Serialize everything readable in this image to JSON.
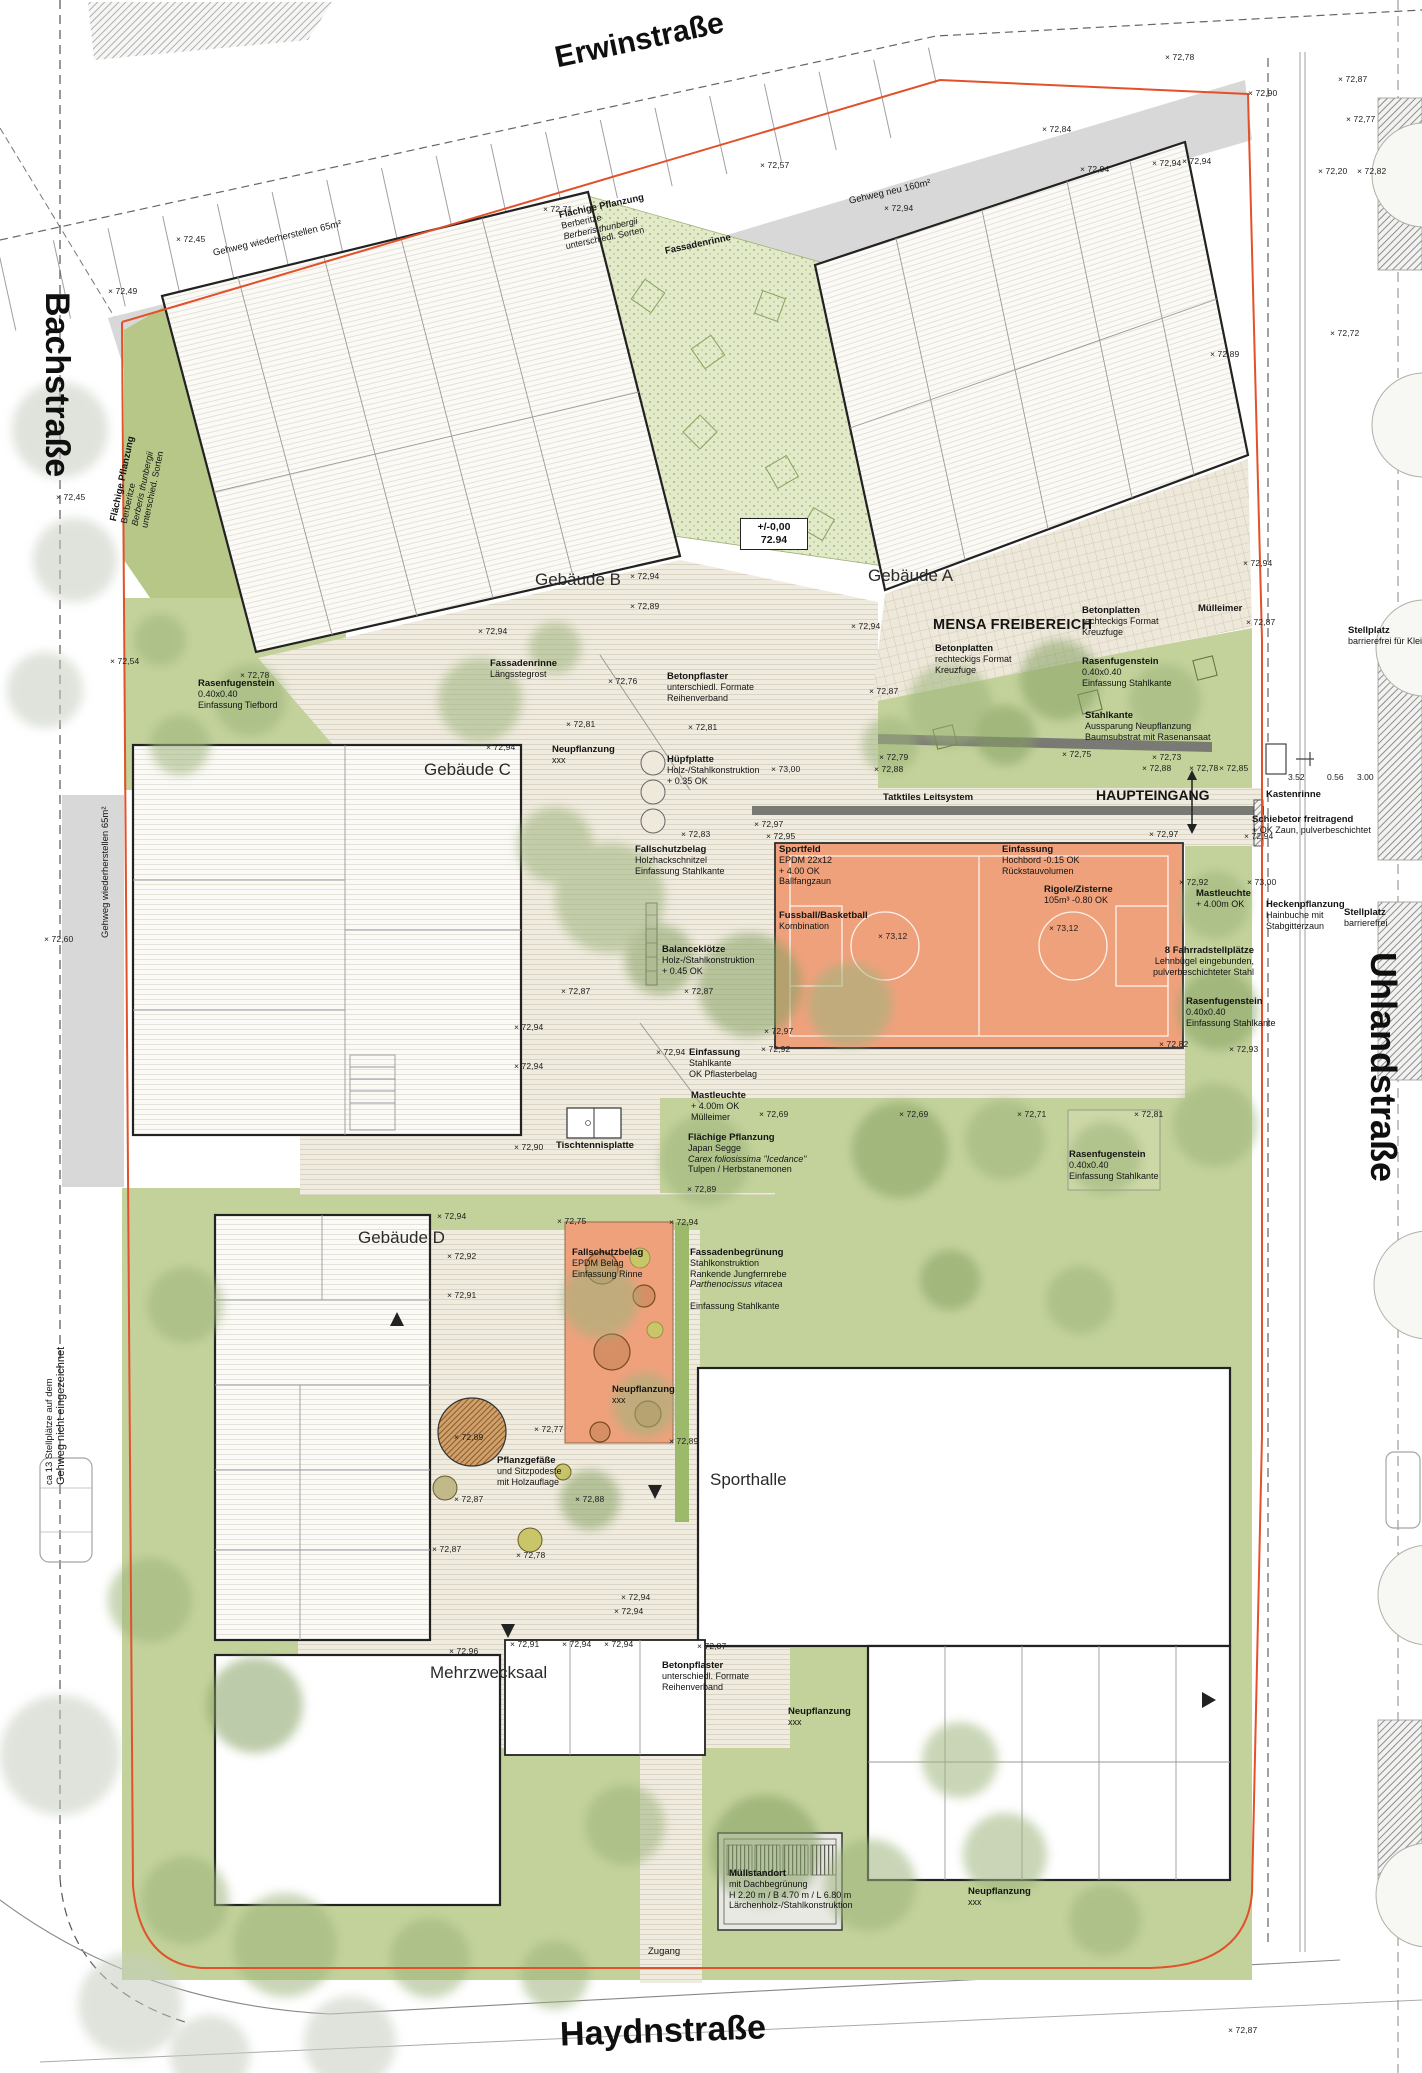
{
  "streets": {
    "top": "Erwinstraße",
    "left": "Bachstraße",
    "right": "Uhlandstraße",
    "bottom": "Haydnstraße"
  },
  "datum": {
    "value_top": "+/-0,00",
    "value_bottom": "72.94"
  },
  "areas": {
    "mensa": "MENSA FREIBEREICH",
    "haupteingang": "HAUPTEINGANG"
  },
  "colors": {
    "boundary": "#e2512a",
    "lawn": "#c3d29b",
    "sportfield": "#efa17c",
    "sidewalk": "#d8d8d8",
    "deck": "#f0ebdf",
    "planting": "#b6c788"
  },
  "buildings": [
    {
      "id": "a",
      "label": "Gebäude A",
      "x": 868,
      "y": 566
    },
    {
      "id": "b",
      "label": "Gebäude B",
      "x": 535,
      "y": 570
    },
    {
      "id": "c",
      "label": "Gebäude C",
      "x": 424,
      "y": 760
    },
    {
      "id": "d",
      "label": "Gebäude D",
      "x": 358,
      "y": 1228
    },
    {
      "id": "sporthalle",
      "label": "Sporthalle",
      "x": 710,
      "y": 1470
    },
    {
      "id": "mehrzwecksaal",
      "label": "Mehrzwecksaal",
      "x": 430,
      "y": 1663
    }
  ],
  "annotations": [
    {
      "id": "gehweg-wiederherstellen-top",
      "x": 212,
      "y": 248,
      "rotate": -13,
      "plain": true,
      "fs": 12.5,
      "title": "Gehweg wiederherstellen 65m²",
      "lines": []
    },
    {
      "id": "gehweg-neu",
      "x": 848,
      "y": 196,
      "rotate": -13,
      "plain": true,
      "fs": 12.5,
      "title": "Gehweg neu 160m²",
      "lines": []
    },
    {
      "id": "flaechige-pflanzung-top",
      "x": 558,
      "y": 210,
      "rotate": -12,
      "title": "Flächige Pflanzung",
      "lines": [
        "Berberitze",
        "Berberis thunbergii",
        "unterschiedl. Sorten"
      ],
      "italics": [
        1
      ]
    },
    {
      "id": "flaechige-pflanzung-left",
      "x": 108,
      "y": 520,
      "rotate": -78,
      "title": "Flächige Pflanzung",
      "lines": [
        "Berberitze",
        "Berberis thunbergii",
        "unterschied. Sorten"
      ],
      "italics": [
        1
      ]
    },
    {
      "id": "fassadenrinne-top",
      "x": 664,
      "y": 246,
      "rotate": -12,
      "title": "Fassadenrinne",
      "lines": []
    },
    {
      "id": "fassadenrinne-laengsstegrost",
      "x": 490,
      "y": 658,
      "title": "Fassadenrinne",
      "lines": [
        "Längsstegrost"
      ]
    },
    {
      "id": "betonpflaster-mitte",
      "x": 667,
      "y": 671,
      "title": "Betonpflaster",
      "lines": [
        "unterschiedl. Formate",
        "Reihenverband"
      ]
    },
    {
      "id": "rasenfugenstein-links",
      "x": 198,
      "y": 678,
      "title": "Rasenfugenstein",
      "lines": [
        "0.40x0.40",
        "Einfassung Tiefbord"
      ]
    },
    {
      "id": "neupflanzung-c",
      "x": 552,
      "y": 744,
      "title": "Neupflanzung",
      "lines": [
        "xxx"
      ]
    },
    {
      "id": "huepfplatte",
      "x": 667,
      "y": 754,
      "title": "Hüpfplatte",
      "lines": [
        "Holz-/Stahlkonstruktion",
        "+ 0.35 OK"
      ]
    },
    {
      "id": "fallschutzbelag-holz",
      "x": 635,
      "y": 844,
      "title": "Fallschutzbelag",
      "lines": [
        "Holzhackschnitzel",
        "Einfassung Stahlkante"
      ]
    },
    {
      "id": "balanceklaetze",
      "x": 662,
      "y": 944,
      "title": "Balanceklötze",
      "lines": [
        "Holz-/Stahlkonstruktion",
        "+ 0.45 OK"
      ]
    },
    {
      "id": "betonplatten-mensa",
      "x": 935,
      "y": 643,
      "title": "Betonplatten",
      "lines": [
        "rechteckigs Format",
        "Kreuzfuge"
      ]
    },
    {
      "id": "betonplatten-rechts",
      "x": 1082,
      "y": 605,
      "title": "Betonplatten",
      "lines": [
        "rechteckigs Format",
        "Kreuzfuge"
      ]
    },
    {
      "id": "muelleimer-mensa",
      "x": 1198,
      "y": 603,
      "title": "Mülleimer",
      "lines": []
    },
    {
      "id": "rasenfugenstein-mensa",
      "x": 1082,
      "y": 656,
      "title": "Rasenfugenstein",
      "lines": [
        "0.40x0.40",
        "Einfassung Stahlkante"
      ]
    },
    {
      "id": "stahlkante-mensa",
      "x": 1085,
      "y": 710,
      "title": "Stahlkante",
      "lines": [
        "Aussparung Neupflanzung",
        "Baumsubstrat mit Rasenansaat"
      ]
    },
    {
      "id": "taktiles-leitsystem",
      "x": 883,
      "y": 792,
      "fs": 10.5,
      "title": "Tatktiles Leitsystem",
      "lines": []
    },
    {
      "id": "kastenrinne",
      "x": 1266,
      "y": 789,
      "fs": 10,
      "title": "Kastenrinne",
      "lines": []
    },
    {
      "id": "schiebetor",
      "x": 1252,
      "y": 814,
      "title": "Schiebetor freitragend",
      "lines": [
        "+ OK Zaun, pulverbeschichtet"
      ]
    },
    {
      "id": "stellplatz-oben",
      "x": 1348,
      "y": 625,
      "title": "Stellplatz",
      "lines": [
        "barrierefrei für Klei"
      ]
    },
    {
      "id": "sportfeld",
      "x": 779,
      "y": 844,
      "title": "Sportfeld",
      "lines": [
        "EPDM 22x12",
        "+ 4.00 OK",
        "Ballfangzaun"
      ]
    },
    {
      "id": "fussball-basketball",
      "x": 779,
      "y": 910,
      "title": "Fussball/Basketball",
      "lines": [
        "Kombination"
      ]
    },
    {
      "id": "einfassung-hochbord",
      "x": 1002,
      "y": 844,
      "title": "Einfassung",
      "lines": [
        "Hochbord -0.15 OK",
        "Rückstauvolumen"
      ]
    },
    {
      "id": "rigole-zisterne",
      "x": 1044,
      "y": 884,
      "title": "Rigole/Zisterne",
      "lines": [
        "105m³  -0.80 OK"
      ]
    },
    {
      "id": "mastleuchte-rechts",
      "x": 1196,
      "y": 888,
      "title": "Mastleuchte",
      "lines": [
        "+ 4.00m OK"
      ]
    },
    {
      "id": "fahrradstellplaetze",
      "x": 1142,
      "y": 945,
      "width": 112,
      "align": "right",
      "title": "8 Fahrradstellplätze",
      "lines": [
        "Lehnbügel eingebunden,",
        "pulverbeschichteter Stahl"
      ]
    },
    {
      "id": "rasenfugenstein-fahrrad",
      "x": 1186,
      "y": 996,
      "title": "Rasenfugenstein",
      "lines": [
        "0.40x0.40",
        "Einfassung Stahlkante"
      ]
    },
    {
      "id": "heckenpflanzung",
      "x": 1266,
      "y": 899,
      "title": "Heckenpflanzung",
      "lines": [
        "Hainbuche mit",
        "Stabgitterzaun"
      ]
    },
    {
      "id": "stellplatz-unten",
      "x": 1344,
      "y": 907,
      "title": "Stellplatz",
      "lines": [
        "barrierefrei"
      ]
    },
    {
      "id": "einfassung-stahlkante",
      "x": 689,
      "y": 1047,
      "title": "Einfassung",
      "lines": [
        "Stahlkante",
        "OK Pflasterbelag"
      ]
    },
    {
      "id": "mastleuchte-mitte",
      "x": 691,
      "y": 1090,
      "title": "Mastleuchte",
      "lines": [
        "+ 4.00m OK",
        "Mülleimer"
      ]
    },
    {
      "id": "flaechige-pflanzung-japan",
      "x": 688,
      "y": 1132,
      "title": "Flächige Pflanzung",
      "lines": [
        "Japan Segge",
        "Carex foliosissima \"Icedance\"",
        "Tulpen / Herbstanemonen"
      ],
      "italics": [
        1
      ]
    },
    {
      "id": "tischtennisplatte",
      "x": 556,
      "y": 1140,
      "fs": 10,
      "title": "Tischtennisplatte",
      "lines": []
    },
    {
      "id": "rasenfugenstein-feld",
      "x": 1069,
      "y": 1149,
      "title": "Rasenfugenstein",
      "lines": [
        "0.40x0.40",
        "Einfassung Stahlkante"
      ]
    },
    {
      "id": "fallschutzbelag-epdm",
      "x": 572,
      "y": 1247,
      "title": "Fallschutzbelag",
      "lines": [
        "EPDM Belag",
        "Einfassung Rinne"
      ]
    },
    {
      "id": "fassadenbegruenung",
      "x": 690,
      "y": 1247,
      "title": "Fassadenbegrünung",
      "lines": [
        "Stahlkonstruktion",
        "Rankende Jungfernrebe",
        "Parthenocissus vitacea",
        "",
        "Einfassung Stahlkante"
      ],
      "italics": [
        2
      ]
    },
    {
      "id": "neupflanzung-spielplatz",
      "x": 612,
      "y": 1384,
      "title": "Neupflanzung",
      "lines": [
        "xxx"
      ]
    },
    {
      "id": "pflanzgefaesse",
      "x": 497,
      "y": 1455,
      "title": "Pflanzgefäße",
      "lines": [
        "und Sitzpodeste",
        "mit Holzauflage"
      ]
    },
    {
      "id": "betonpflaster-unten",
      "x": 662,
      "y": 1660,
      "title": "Betonpflaster",
      "lines": [
        "unterschiedl. Formate",
        "Reihenverband"
      ]
    },
    {
      "id": "neupflanzung-unten-1",
      "x": 788,
      "y": 1706,
      "title": "Neupflanzung",
      "lines": [
        "xxx"
      ]
    },
    {
      "id": "neupflanzung-unten-2",
      "x": 968,
      "y": 1886,
      "title": "Neupflanzung",
      "lines": [
        "xxx"
      ]
    },
    {
      "id": "muellstandort",
      "x": 729,
      "y": 1868,
      "title": "Müllstandort",
      "lines": [
        "mit Dachbegrünung",
        "H 2.20 m / B 4.70 m / L 6.80 m",
        "Lärchenholz-/Stahlkonstruktion"
      ]
    },
    {
      "id": "zugang",
      "x": 648,
      "y": 1946,
      "plain": true,
      "fs": 11,
      "title": "Zugang",
      "lines": []
    },
    {
      "id": "stellplaetze-hinweis",
      "x": 44,
      "y": 1485,
      "rotate": -90,
      "plain": true,
      "fs": 11,
      "title": "ca 13 Stellplätze auf dem",
      "lines": [
        "Gehweg nicht eingezeichnet"
      ]
    },
    {
      "id": "gehweg-wiederherstellen-links",
      "x": 100,
      "y": 938,
      "rotate": -90,
      "plain": true,
      "fs": 10.5,
      "title": "Gehweg wiederherstellen 65m²",
      "lines": []
    }
  ],
  "dimensions": [
    {
      "x": 1288,
      "y": 772,
      "v": "3.52"
    },
    {
      "x": 1327,
      "y": 772,
      "v": "0.56"
    },
    {
      "x": 1357,
      "y": 772,
      "v": "3.00"
    }
  ],
  "spot_heights": [
    {
      "x": 1165,
      "y": 52,
      "v": "72,78"
    },
    {
      "x": 1248,
      "y": 88,
      "v": "72,90"
    },
    {
      "x": 1042,
      "y": 124,
      "v": "72,84"
    },
    {
      "x": 1152,
      "y": 158,
      "v": "72,94"
    },
    {
      "x": 1338,
      "y": 74,
      "v": "72,87"
    },
    {
      "x": 1346,
      "y": 114,
      "v": "72,77"
    },
    {
      "x": 760,
      "y": 160,
      "v": "72,57"
    },
    {
      "x": 543,
      "y": 204,
      "v": "72,71"
    },
    {
      "x": 1080,
      "y": 164,
      "v": "72,94"
    },
    {
      "x": 1182,
      "y": 156,
      "v": "72,94"
    },
    {
      "x": 884,
      "y": 203,
      "v": "72,94"
    },
    {
      "x": 176,
      "y": 234,
      "v": "72,45"
    },
    {
      "x": 108,
      "y": 286,
      "v": "72,49"
    },
    {
      "x": 1318,
      "y": 166,
      "v": "72,20"
    },
    {
      "x": 1357,
      "y": 166,
      "v": "72,82"
    },
    {
      "x": 1210,
      "y": 349,
      "v": "72,89"
    },
    {
      "x": 1330,
      "y": 328,
      "v": "72,72"
    },
    {
      "x": 56,
      "y": 492,
      "v": "72,45"
    },
    {
      "x": 110,
      "y": 656,
      "v": "72,54"
    },
    {
      "x": 240,
      "y": 670,
      "v": "72,78"
    },
    {
      "x": 44,
      "y": 934,
      "v": "72,60"
    },
    {
      "x": 630,
      "y": 571,
      "v": "72,94"
    },
    {
      "x": 630,
      "y": 601,
      "v": "72,89"
    },
    {
      "x": 478,
      "y": 626,
      "v": "72,94"
    },
    {
      "x": 608,
      "y": 676,
      "v": "72,76"
    },
    {
      "x": 566,
      "y": 719,
      "v": "72,81"
    },
    {
      "x": 688,
      "y": 722,
      "v": "72,81"
    },
    {
      "x": 486,
      "y": 742,
      "v": "72,94"
    },
    {
      "x": 681,
      "y": 829,
      "v": "72,83"
    },
    {
      "x": 561,
      "y": 986,
      "v": "72,87"
    },
    {
      "x": 684,
      "y": 986,
      "v": "72,87"
    },
    {
      "x": 851,
      "y": 621,
      "v": "72,94"
    },
    {
      "x": 1243,
      "y": 558,
      "v": "72,94"
    },
    {
      "x": 869,
      "y": 686,
      "v": "72,87"
    },
    {
      "x": 1246,
      "y": 617,
      "v": "72,87"
    },
    {
      "x": 771,
      "y": 764,
      "v": "73,00"
    },
    {
      "x": 879,
      "y": 752,
      "v": "72,79"
    },
    {
      "x": 874,
      "y": 764,
      "v": "72,88"
    },
    {
      "x": 1062,
      "y": 749,
      "v": "72,75"
    },
    {
      "x": 1152,
      "y": 752,
      "v": "72,73"
    },
    {
      "x": 1142,
      "y": 763,
      "v": "72,88"
    },
    {
      "x": 1189,
      "y": 763,
      "v": "72,78"
    },
    {
      "x": 1219,
      "y": 763,
      "v": "72,85"
    },
    {
      "x": 754,
      "y": 819,
      "v": "72,97"
    },
    {
      "x": 766,
      "y": 831,
      "v": "72,95"
    },
    {
      "x": 1149,
      "y": 829,
      "v": "72,97"
    },
    {
      "x": 1244,
      "y": 831,
      "v": "72,94"
    },
    {
      "x": 1179,
      "y": 877,
      "v": "72,92"
    },
    {
      "x": 1247,
      "y": 877,
      "v": "73,00"
    },
    {
      "x": 878,
      "y": 931,
      "v": "73,12"
    },
    {
      "x": 1049,
      "y": 923,
      "v": "73,12"
    },
    {
      "x": 764,
      "y": 1026,
      "v": "72,97"
    },
    {
      "x": 761,
      "y": 1044,
      "v": "72,92"
    },
    {
      "x": 1159,
      "y": 1039,
      "v": "72,82"
    },
    {
      "x": 1229,
      "y": 1044,
      "v": "72,93"
    },
    {
      "x": 514,
      "y": 1022,
      "v": "72,94"
    },
    {
      "x": 514,
      "y": 1061,
      "v": "72,94"
    },
    {
      "x": 656,
      "y": 1047,
      "v": "72,94"
    },
    {
      "x": 514,
      "y": 1142,
      "v": "72,90"
    },
    {
      "x": 759,
      "y": 1109,
      "v": "72,69"
    },
    {
      "x": 899,
      "y": 1109,
      "v": "72,69"
    },
    {
      "x": 1017,
      "y": 1109,
      "v": "72,71"
    },
    {
      "x": 1134,
      "y": 1109,
      "v": "72,81"
    },
    {
      "x": 687,
      "y": 1184,
      "v": "72,89"
    },
    {
      "x": 437,
      "y": 1211,
      "v": "72,94"
    },
    {
      "x": 447,
      "y": 1251,
      "v": "72,92"
    },
    {
      "x": 447,
      "y": 1290,
      "v": "72,91"
    },
    {
      "x": 557,
      "y": 1216,
      "v": "72,75"
    },
    {
      "x": 669,
      "y": 1217,
      "v": "72,94"
    },
    {
      "x": 534,
      "y": 1424,
      "v": "72,77"
    },
    {
      "x": 669,
      "y": 1436,
      "v": "72,89"
    },
    {
      "x": 454,
      "y": 1432,
      "v": "72,89"
    },
    {
      "x": 454,
      "y": 1494,
      "v": "72,87"
    },
    {
      "x": 575,
      "y": 1494,
      "v": "72,88"
    },
    {
      "x": 432,
      "y": 1544,
      "v": "72,87"
    },
    {
      "x": 516,
      "y": 1550,
      "v": "72,78"
    },
    {
      "x": 621,
      "y": 1592,
      "v": "72,94"
    },
    {
      "x": 449,
      "y": 1646,
      "v": "72,96"
    },
    {
      "x": 510,
      "y": 1639,
      "v": "72,91"
    },
    {
      "x": 562,
      "y": 1639,
      "v": "72,94"
    },
    {
      "x": 604,
      "y": 1639,
      "v": "72,94"
    },
    {
      "x": 697,
      "y": 1641,
      "v": "72,87"
    },
    {
      "x": 614,
      "y": 1606,
      "v": "72,94"
    },
    {
      "x": 1228,
      "y": 2025,
      "v": "72,87"
    }
  ]
}
